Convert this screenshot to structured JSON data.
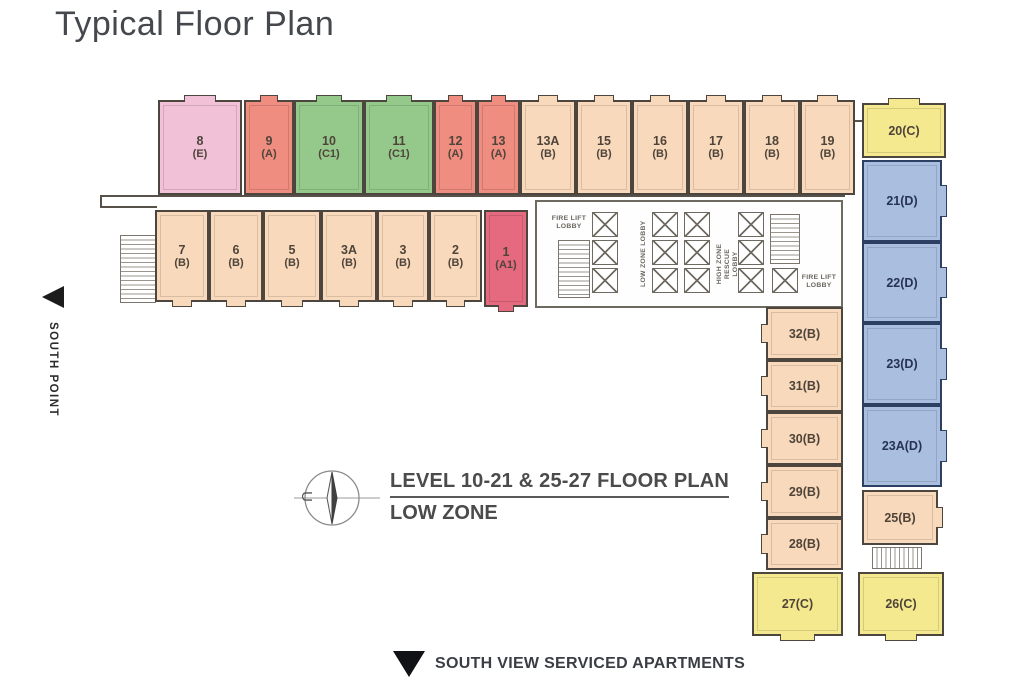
{
  "page": {
    "title": "Typical Floor Plan"
  },
  "annotations": {
    "south_point": "SOUTH POINT",
    "compass_letter": "U",
    "plan_title": "LEVEL 10-21 & 25-27 FLOOR PLAN",
    "plan_subtitle": "LOW ZONE",
    "bottom_caption": "SOUTH VIEW SERVICED APARTMENTS"
  },
  "core": {
    "fire_lift_lobby": "FIRE LIFT LOBBY",
    "low_zone_lobby": "LOW ZONE LOBBY",
    "high_zone_rescue_lobby": "HIGH ZONE RESCUE LOBBY",
    "lifts": [
      [
        592,
        212
      ],
      [
        592,
        240
      ],
      [
        592,
        268
      ],
      [
        652,
        212
      ],
      [
        652,
        240
      ],
      [
        652,
        268
      ],
      [
        684,
        212
      ],
      [
        684,
        240
      ],
      [
        684,
        268
      ],
      [
        738,
        212
      ],
      [
        738,
        240
      ],
      [
        738,
        268
      ],
      [
        772,
        268
      ]
    ],
    "stairs": [
      {
        "x": 558,
        "y": 240,
        "w": 32,
        "h": 58,
        "d": "v"
      },
      {
        "x": 770,
        "y": 214,
        "w": 30,
        "h": 50,
        "d": "v"
      },
      {
        "x": 120,
        "y": 235,
        "w": 36,
        "h": 68,
        "d": "v"
      },
      {
        "x": 872,
        "y": 547,
        "w": 50,
        "h": 22,
        "d": "r"
      }
    ]
  },
  "lines": [
    {
      "x": 100,
      "y": 195,
      "w": 745,
      "h": 2
    },
    {
      "x": 100,
      "y": 206,
      "w": 57,
      "h": 2
    },
    {
      "x": 100,
      "y": 195,
      "w": 2,
      "h": 13
    },
    {
      "x": 845,
      "y": 120,
      "w": 17,
      "h": 2
    }
  ],
  "colors": {
    "pink": "#f0c1d7",
    "salmon": "#ee8d80",
    "green": "#95c98c",
    "peach": "#f8d9bb",
    "red": "#e5697f",
    "yellow": "#f4e98e",
    "blue": "#aabfe0",
    "wall": "#4c463f",
    "blueWall": "#2d3f63",
    "label": "#4f443a",
    "blueLabel": "#263257"
  },
  "units": [
    {
      "name": "8E",
      "label": "8",
      "sub": "(E)",
      "color": "pink",
      "x": 158,
      "y": 100,
      "w": 84,
      "h": 95,
      "bump": "top"
    },
    {
      "name": "9A",
      "label": "9",
      "sub": "(A)",
      "color": "salmon",
      "x": 244,
      "y": 100,
      "w": 50,
      "h": 95,
      "bump": "top"
    },
    {
      "name": "10C1",
      "label": "10",
      "sub": "(C1)",
      "color": "green",
      "x": 294,
      "y": 100,
      "w": 70,
      "h": 95,
      "bump": "top"
    },
    {
      "name": "11C1",
      "label": "11",
      "sub": "(C1)",
      "color": "green",
      "x": 364,
      "y": 100,
      "w": 70,
      "h": 95,
      "bump": "top"
    },
    {
      "name": "12A",
      "label": "12",
      "sub": "(A)",
      "color": "salmon",
      "x": 434,
      "y": 100,
      "w": 43,
      "h": 95,
      "bump": "top"
    },
    {
      "name": "13A",
      "label": "13",
      "sub": "(A)",
      "color": "salmon",
      "x": 477,
      "y": 100,
      "w": 43,
      "h": 95,
      "bump": "top"
    },
    {
      "name": "13AB",
      "label": "13A",
      "sub": "(B)",
      "color": "peach",
      "x": 520,
      "y": 100,
      "w": 56,
      "h": 95,
      "bump": "top"
    },
    {
      "name": "15B",
      "label": "15",
      "sub": "(B)",
      "color": "peach",
      "x": 576,
      "y": 100,
      "w": 56,
      "h": 95,
      "bump": "top"
    },
    {
      "name": "16B",
      "label": "16",
      "sub": "(B)",
      "color": "peach",
      "x": 632,
      "y": 100,
      "w": 56,
      "h": 95,
      "bump": "top"
    },
    {
      "name": "17B",
      "label": "17",
      "sub": "(B)",
      "color": "peach",
      "x": 688,
      "y": 100,
      "w": 56,
      "h": 95,
      "bump": "top"
    },
    {
      "name": "18B",
      "label": "18",
      "sub": "(B)",
      "color": "peach",
      "x": 744,
      "y": 100,
      "w": 56,
      "h": 95,
      "bump": "top"
    },
    {
      "name": "19B",
      "label": "19",
      "sub": "(B)",
      "color": "peach",
      "x": 800,
      "y": 100,
      "w": 55,
      "h": 95,
      "bump": "top"
    },
    {
      "name": "7B",
      "label": "7",
      "sub": "(B)",
      "color": "peach",
      "x": 155,
      "y": 210,
      "w": 54,
      "h": 92,
      "bump": "bottom"
    },
    {
      "name": "6B",
      "label": "6",
      "sub": "(B)",
      "color": "peach",
      "x": 209,
      "y": 210,
      "w": 54,
      "h": 92,
      "bump": "bottom"
    },
    {
      "name": "5B",
      "label": "5",
      "sub": "(B)",
      "color": "peach",
      "x": 263,
      "y": 210,
      "w": 58,
      "h": 92,
      "bump": "bottom"
    },
    {
      "name": "3AB",
      "label": "3A",
      "sub": "(B)",
      "color": "peach",
      "x": 321,
      "y": 210,
      "w": 56,
      "h": 92,
      "bump": "bottom"
    },
    {
      "name": "3B",
      "label": "3",
      "sub": "(B)",
      "color": "peach",
      "x": 377,
      "y": 210,
      "w": 52,
      "h": 92,
      "bump": "bottom"
    },
    {
      "name": "2B",
      "label": "2",
      "sub": "(B)",
      "color": "peach",
      "x": 429,
      "y": 210,
      "w": 53,
      "h": 92,
      "bump": "bottom"
    },
    {
      "name": "1A1",
      "label": "1",
      "sub": "(A1)",
      "color": "red",
      "x": 484,
      "y": 210,
      "w": 44,
      "h": 97,
      "bump": "bottom"
    },
    {
      "name": "32B",
      "label": "32(B)",
      "sub": "",
      "color": "peach",
      "x": 766,
      "y": 307,
      "w": 77,
      "h": 53,
      "bump": "left"
    },
    {
      "name": "31B",
      "label": "31(B)",
      "sub": "",
      "color": "peach",
      "x": 766,
      "y": 360,
      "w": 77,
      "h": 52,
      "bump": "left"
    },
    {
      "name": "30B",
      "label": "30(B)",
      "sub": "",
      "color": "peach",
      "x": 766,
      "y": 412,
      "w": 77,
      "h": 53,
      "bump": "left"
    },
    {
      "name": "29B",
      "label": "29(B)",
      "sub": "",
      "color": "peach",
      "x": 766,
      "y": 465,
      "w": 77,
      "h": 53,
      "bump": "left"
    },
    {
      "name": "28B",
      "label": "28(B)",
      "sub": "",
      "color": "peach",
      "x": 766,
      "y": 518,
      "w": 77,
      "h": 52,
      "bump": "left"
    },
    {
      "name": "27C",
      "label": "27(C)",
      "sub": "",
      "color": "yellow",
      "x": 752,
      "y": 572,
      "w": 91,
      "h": 64,
      "bump": "bottom"
    },
    {
      "name": "20C",
      "label": "20(C)",
      "sub": "",
      "color": "yellow",
      "x": 862,
      "y": 103,
      "w": 84,
      "h": 55,
      "bump": "top"
    },
    {
      "name": "21D",
      "label": "21(D)",
      "sub": "",
      "color": "blue",
      "x": 862,
      "y": 160,
      "w": 80,
      "h": 82,
      "bump": "right"
    },
    {
      "name": "22D",
      "label": "22(D)",
      "sub": "",
      "color": "blue",
      "x": 862,
      "y": 242,
      "w": 80,
      "h": 81,
      "bump": "right"
    },
    {
      "name": "23D",
      "label": "23(D)",
      "sub": "",
      "color": "blue",
      "x": 862,
      "y": 323,
      "w": 80,
      "h": 82,
      "bump": "right"
    },
    {
      "name": "23AD",
      "label": "23A(D)",
      "sub": "",
      "color": "blue",
      "x": 862,
      "y": 405,
      "w": 80,
      "h": 82,
      "bump": "right"
    },
    {
      "name": "25B",
      "label": "25(B)",
      "sub": "",
      "color": "peach",
      "x": 862,
      "y": 490,
      "w": 76,
      "h": 55,
      "bump": "right"
    },
    {
      "name": "26C",
      "label": "26(C)",
      "sub": "",
      "color": "yellow",
      "x": 858,
      "y": 572,
      "w": 86,
      "h": 64,
      "bump": "bottom"
    }
  ]
}
